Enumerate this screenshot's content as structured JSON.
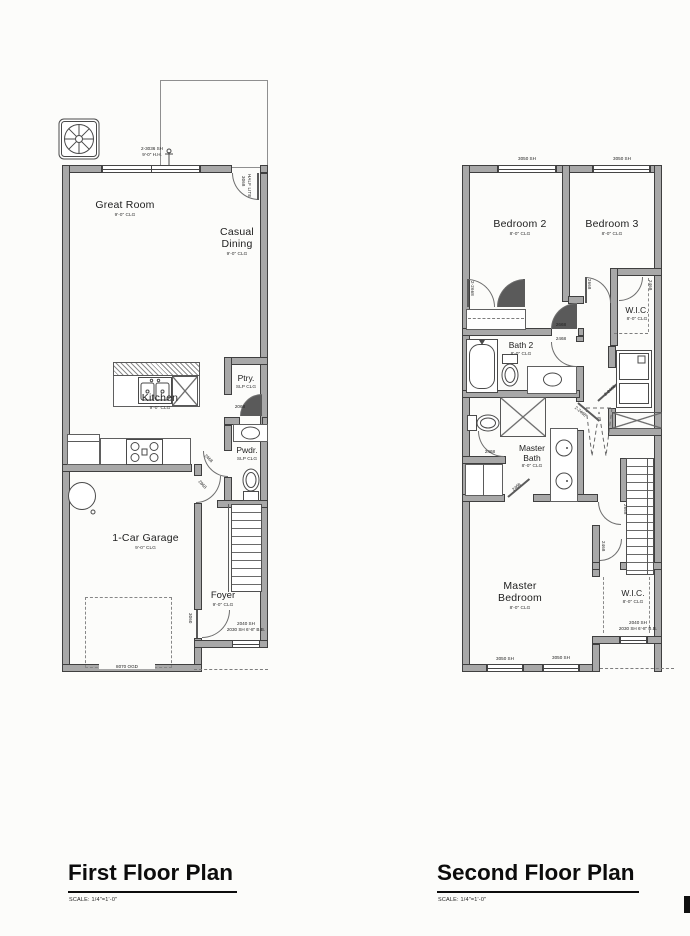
{
  "titles": {
    "first": "First Floor Plan",
    "first_scale": "SCALE: 1/4\"=1'-0\"",
    "second": "Second Floor Plan",
    "second_scale": "SCALE: 1/4\"=1'-0\""
  },
  "first": {
    "rooms": {
      "great_room": {
        "name": "Great Room",
        "clg": "9'-0\" CLG"
      },
      "casual_dining": {
        "name": "Casual",
        "name2": "Dining",
        "clg": "9'-0\" CLG"
      },
      "kitchen": {
        "name": "Kitchen",
        "clg": "9'-0\" CLG"
      },
      "pantry": {
        "name": "Ptry.",
        "clg": "SLP CLG"
      },
      "powder": {
        "name": "Pwdr.",
        "clg": "SLP CLG"
      },
      "garage": {
        "name": "1-Car Garage",
        "clg": "9'-0\" CLG"
      },
      "foyer": {
        "name": "Foyer",
        "clg": "9'-0\" CLG"
      }
    },
    "labels": {
      "window_top1": "2-3036 SH",
      "window_top2": "9'-0\" H.H.",
      "entry_door1": "3068",
      "entry_door2": "HALF LITE",
      "pantry_door": "2068",
      "powder_door": "2468",
      "garage_door": "2868",
      "foyer_door": "3060",
      "garage_ohd": "8070 OGD",
      "foyer_window1": "2040 SH",
      "foyer_window2": "2030 SH 6'-8\" B.B."
    }
  },
  "second": {
    "rooms": {
      "bedroom2": {
        "name": "Bedroom 2",
        "clg": "8'-0\" CLG"
      },
      "bedroom3": {
        "name": "Bedroom 3",
        "clg": "8'-0\" CLG"
      },
      "wic_top": {
        "name": "W.I.C.",
        "clg": "8'-0\" CLG"
      },
      "bath2": {
        "name": "Bath 2",
        "clg": "8'-0\" CLG"
      },
      "master_bath": {
        "name": "Master",
        "name2": "Bath",
        "clg": "8'-0\" CLG"
      },
      "master_bedroom": {
        "name": "Master",
        "name2": "Bedroom",
        "clg": "8'-0\" CLG"
      },
      "wic_bottom": {
        "name": "W.I.C.",
        "clg": "8'-0\" CLG"
      }
    },
    "labels": {
      "window_top_left": "3050 SH",
      "window_top_right": "3050 SH",
      "window_bottom_left": "3050 SH",
      "window_bottom_right": "3050 SH",
      "bed2_closet_door": "2-2668",
      "bed2_door": "2668",
      "bed3_door": "2668",
      "wic_top_door": "2468",
      "bath2_door": "2468",
      "master_bath_door": "2468",
      "master_entry_door": "2468",
      "laundry_door": "2-2468",
      "mech_door": "2-2468",
      "mbed_door": "2668",
      "wic_bottom_door": "2468",
      "wic_window1": "2040 SH",
      "wic_window2": "2030 SH 6'-8\" B.B."
    }
  }
}
